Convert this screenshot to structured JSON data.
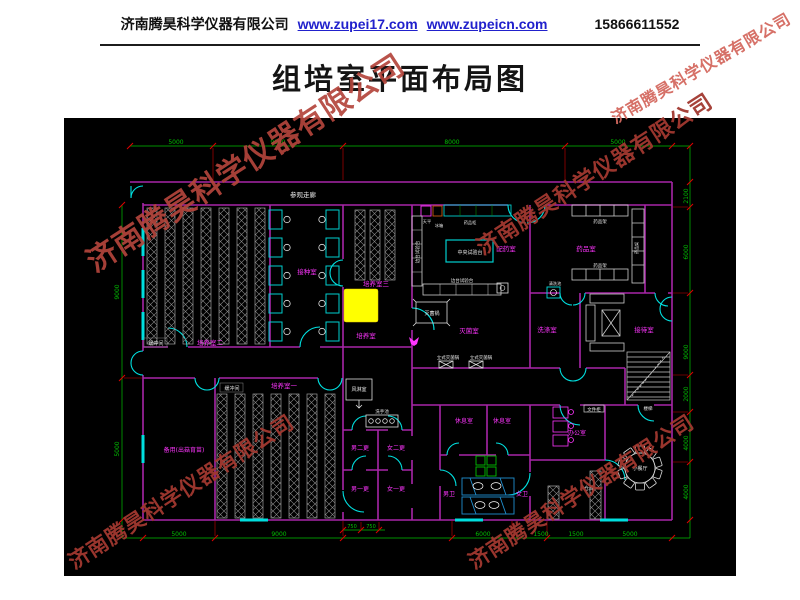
{
  "header": {
    "company": "济南腾昊科学仪器有限公司",
    "website1": "www.zupei17.com",
    "website2": "www.zupeicn.com",
    "phone": "15866611552"
  },
  "title": "组培室平面布局图",
  "watermark": {
    "text": "济南腾昊科学仪器有限公司"
  },
  "colors": {
    "background": "#000000",
    "wall": "#a825a8",
    "door_window": "#00e0e0",
    "dimension_green": "#00c000",
    "dimension_tick_red": "#e00000",
    "room_label_magenta": "#ff35ff",
    "furniture_white": "#d8d8d8",
    "highlight_yellow": "#ffff00",
    "watermark_red": "#c0392b",
    "link_blue": "#2121cc"
  },
  "floorplan": {
    "labels": {
      "corridor": "参观走廊",
      "culture_room_2": "培养室二",
      "culture_room_3": "培养室三",
      "culture_room_1": "培养室一",
      "culture_room": "培养室",
      "inoculation_room": "接种室",
      "buffer_a": "缓冲间",
      "buffer_b": "缓冲间",
      "spare_room": "备用(出菇育苗)",
      "media_room": "配药室",
      "chemical_room": "药品室",
      "sterilization_room": "灭菌室",
      "washing_room": "洗涤室",
      "reception_room": "接待室",
      "air_shower": "风淋室",
      "hand_sink": "洗手池",
      "wash_pool": "清洗池",
      "male_change_2": "男二更",
      "female_change_2": "女二更",
      "male_change_1": "男一更",
      "female_change_1": "女一更",
      "rest_room_a": "休息室",
      "rest_room_b": "休息室",
      "male_wc": "男卫",
      "female_wc": "女卫",
      "office": "办公室",
      "file_cabinet": "文件柜",
      "storage": "仓库",
      "dining": "小餐厅",
      "stairs": "楼梯",
      "central_bench": "中央试验台",
      "side_bench_a": "边台试验台",
      "side_bench_b": "边台试验台",
      "balance": "天平",
      "fridge": "冰箱",
      "chemical_cabinet": "药品柜",
      "chemical_rack_a": "药品架",
      "chemical_rack_b": "药品架",
      "chemical_rack_c": "药品架",
      "autoclave": "灭菌锅",
      "vertical_autoclave_a": "立式灭菌锅",
      "vertical_autoclave_b": "立式灭菌锅"
    },
    "dims": {
      "top": [
        "5000",
        "9000",
        "8000",
        "5000"
      ],
      "left": [
        "9000",
        "5000"
      ],
      "right": [
        "2100",
        "6000",
        "9000",
        "2000",
        "4000",
        "4000"
      ],
      "bottom": [
        "5000",
        "9000",
        "750",
        "750",
        "6000",
        "1500",
        "1500",
        "5000"
      ]
    }
  }
}
